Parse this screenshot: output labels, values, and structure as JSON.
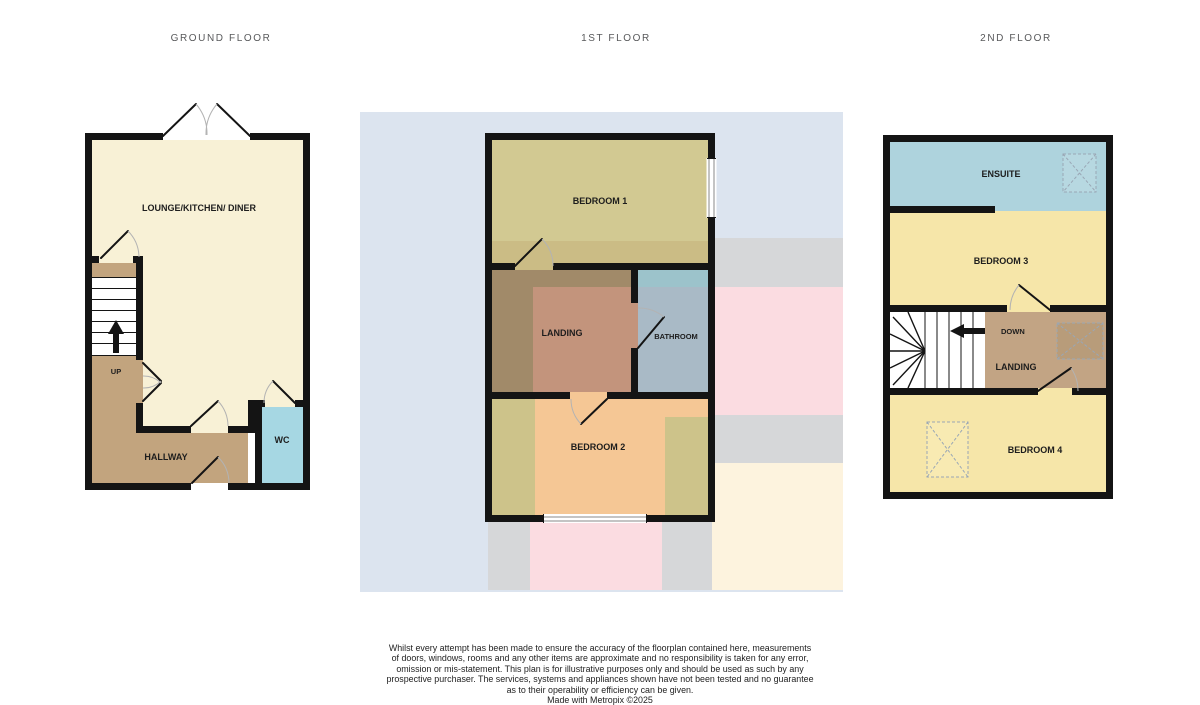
{
  "floors": {
    "ground": {
      "title": "GROUND FLOOR",
      "rooms": {
        "lounge": "LOUNGE/KITCHEN/ DINER",
        "hallway": "HALLWAY",
        "wc": "WC"
      },
      "stairs_label": "UP"
    },
    "first": {
      "title": "1ST FLOOR",
      "rooms": {
        "bedroom1": "BEDROOM 1",
        "landing": "LANDING",
        "bathroom": "BATHROOM",
        "bedroom2": "BEDROOM 2"
      }
    },
    "second": {
      "title": "2ND FLOOR",
      "rooms": {
        "ensuite": "ENSUITE",
        "bedroom3": "BEDROOM 3",
        "landing": "LANDING",
        "bedroom4": "BEDROOM 4"
      },
      "stairs_label": "DOWN"
    }
  },
  "colors": {
    "wall": "#141414",
    "lounge": "#f8f1d6",
    "hallway": "#c2a47e",
    "wc": "#a6d7e3",
    "stairs": "#ffffff",
    "bedroom1": "#d2c992",
    "bedroom1_band": "#cbbc85",
    "landing1": "#a18a69",
    "landing1_salmon": "#c3947c",
    "bathroom": "#a9bac6",
    "bathroom_teal": "#9cc3cb",
    "bedroom2": "#f5c795",
    "bedroom2_olive": "#cdc38a",
    "ensuite": "#aed3dd",
    "shower": "#b7d8e1",
    "bedroom_yellow": "#f6e6a9",
    "landing2": "#c2a484",
    "skylight_tan": "#b89c7a",
    "skylight_yellow": "#f8eab2",
    "ghost_blue": "#dce4ef",
    "ghost_gray": "#d6d7d9",
    "ghost_pink": "#fbdce1",
    "ghost_cream": "#fdf3de"
  },
  "disclaimer": {
    "line1": "Whilst every attempt has been made to ensure the accuracy of the floorplan contained here, measurements",
    "line2": "of doors, windows, rooms and any other items are approximate and no responsibility is taken for any error,",
    "line3": "omission or mis-statement. This plan is for illustrative purposes only and should be used as such by any",
    "line4": "prospective purchaser. The services, systems and appliances shown have not been tested and no guarantee",
    "line5": "as to their operability or efficiency can be given.",
    "line6": "Made with Metropix ©2025"
  }
}
